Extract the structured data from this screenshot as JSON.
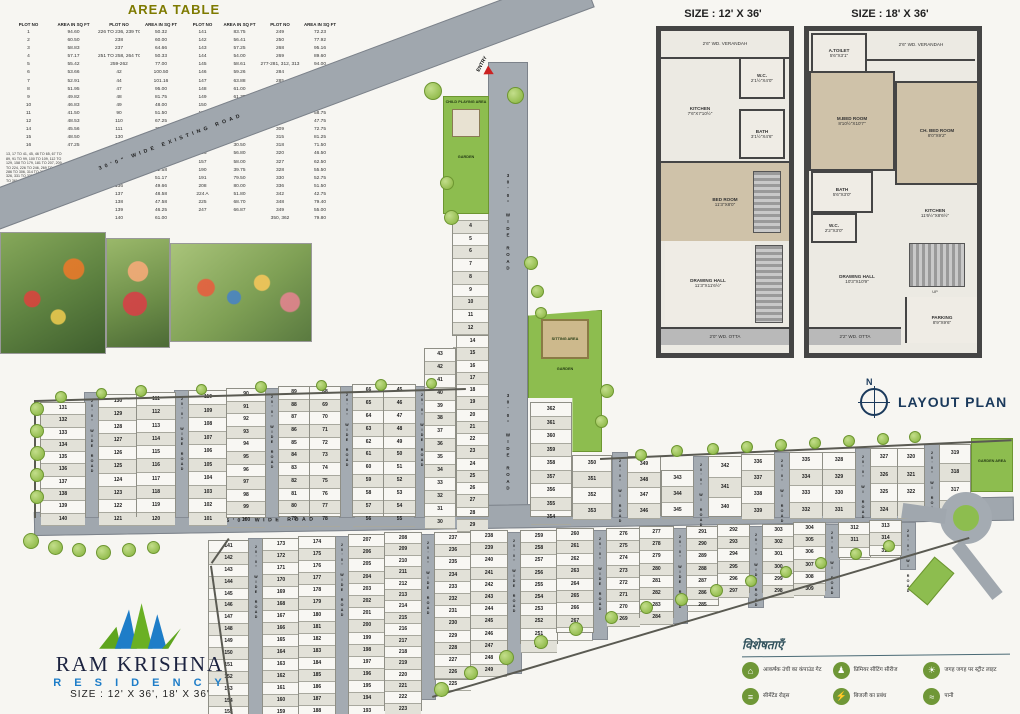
{
  "area_table": {
    "title": "AREA TABLE",
    "headers": [
      "PLOT NO",
      "AREA IN SQ FT"
    ],
    "pairs": [
      {
        "rows": [
          [
            "1",
            "94.60"
          ],
          [
            "2",
            "60.50"
          ],
          [
            "3",
            "58.83"
          ],
          [
            "4",
            "57.17"
          ],
          [
            "5",
            "55.42"
          ],
          [
            "6",
            "53.66"
          ],
          [
            "7",
            "52.91"
          ],
          [
            "8",
            "51.95"
          ],
          [
            "9",
            "49.82"
          ],
          [
            "10",
            "46.83"
          ],
          [
            "11",
            "41.50"
          ],
          [
            "12",
            "48.53"
          ],
          [
            "14",
            "45.56"
          ],
          [
            "15",
            "48.50"
          ],
          [
            "16",
            "47.25"
          ]
        ],
        "groups": [
          {
            "plots": "13, 17 TO 41, 45, 46 TO 65, 67 TO 89, 91 TO 99, 100 TO 109, 112 TO 129, 158 TO 179, 181 TO 207, 209 TO 224, 226 TO 246, 269 TO 275, 286 TO 306, 314 TO 317, 321 TO 326, 331 TO 335, 343 TO 347, 351 TO 361",
            "area": "58.30"
          },
          {
            "plots": "225, 229 TO 234, 253 TO 262, 276, 282, 283, 290 TO 298, 310, 311, 319, 337 TO 342, 345, 349, 350 TO 356",
            "area": "72.59"
          }
        ]
      },
      {
        "rows": [
          [
            "226 TO 236, 239 TO 248",
            "50.32"
          ],
          [
            "238",
            "60.00"
          ],
          [
            "237",
            "64.66"
          ],
          [
            "251 TO 258, 264 TO 267",
            "50.33"
          ],
          [
            "259-262",
            "77.00"
          ],
          [
            "42",
            "100.50"
          ],
          [
            "44",
            "101.16"
          ],
          [
            "47",
            "95.00"
          ],
          [
            "48",
            "81.75"
          ],
          [
            "49",
            "48.00"
          ],
          [
            "90",
            "51.50"
          ],
          [
            "110",
            "67.25"
          ],
          [
            "111",
            "72.60"
          ],
          [
            "130",
            "67.50"
          ],
          [
            "131",
            "108.50"
          ],
          [
            "132",
            "54.50"
          ],
          [
            "133",
            "53.83"
          ],
          [
            "134",
            "52.58"
          ],
          [
            "135",
            "51.17"
          ],
          [
            "136",
            "49.66"
          ],
          [
            "137",
            "48.58"
          ],
          [
            "138",
            "47.58"
          ],
          [
            "139",
            "46.25"
          ],
          [
            "140",
            "61.00"
          ]
        ],
        "groups": []
      },
      {
        "rows": [
          [
            "141",
            "83.75"
          ],
          [
            "142",
            "56.41"
          ],
          [
            "143",
            "57.25"
          ],
          [
            "144",
            "54.00"
          ],
          [
            "145",
            "58.61"
          ],
          [
            "146",
            "59.26"
          ],
          [
            "147",
            "63.88"
          ],
          [
            "148",
            "61.00"
          ],
          [
            "149",
            "61.75"
          ],
          [
            "150",
            "44.31"
          ],
          [
            "151",
            "35.91"
          ],
          [
            "152",
            "34.50"
          ],
          [
            "153",
            "33.36"
          ],
          [
            "154",
            "31.88"
          ],
          [
            "155",
            "30.50"
          ],
          [
            "156",
            "56.80"
          ],
          [
            "157",
            "58.00"
          ],
          [
            "190",
            "39.75"
          ],
          [
            "191",
            "79.50"
          ],
          [
            "208",
            "80.00"
          ],
          [
            "224 A",
            "51.80"
          ],
          [
            "225",
            "68.70"
          ],
          [
            "247",
            "66.87"
          ]
        ],
        "groups": []
      },
      {
        "rows": [
          [
            "249",
            "72.23"
          ],
          [
            "250",
            "77.92"
          ],
          [
            "268",
            "95.16"
          ],
          [
            "269",
            "89.60"
          ],
          [
            "277-281, 312, 313",
            "94.00"
          ],
          [
            "284",
            "41.25"
          ],
          [
            "285",
            "44.25"
          ],
          [
            "287",
            "75.75"
          ],
          [
            "288",
            "55.25"
          ],
          [
            "289",
            "54.00"
          ],
          [
            "307",
            "58.75"
          ],
          [
            "308",
            "47.75"
          ],
          [
            "309",
            "72.75"
          ],
          [
            "315",
            "81.25"
          ],
          [
            "318",
            "71.50"
          ],
          [
            "320",
            "46.50"
          ],
          [
            "327",
            "62.50"
          ],
          [
            "328",
            "55.50"
          ],
          [
            "330",
            "52.75"
          ],
          [
            "336",
            "51.50"
          ],
          [
            "342",
            "42.75"
          ],
          [
            "348",
            "79.40"
          ],
          [
            "349",
            "55.00"
          ],
          [
            "350, 362",
            "79.80"
          ]
        ],
        "groups": []
      }
    ]
  },
  "floor12": {
    "title": "SIZE : 12' X 36'",
    "verandah": "2'6\" WD. VERANDAH",
    "wc_name": "W.C.",
    "wc_dims": "2'1½\"X4'0\"",
    "kitchen_name": "KITCHEN",
    "kitchen_dims": "7'6\"X7'10½\"",
    "bath_name": "BATH",
    "bath_dims": "3'1½\"X4'6\"",
    "bed_name": "BED ROOM",
    "bed_dims": "11'3\"X8'0\"",
    "hall_name": "DRAWING HALL",
    "hall_dims": "11'3\"X11'6½\"",
    "otta": "2'0\" WD. OTTA"
  },
  "floor18": {
    "title": "SIZE : 18' X 36'",
    "toilet_name": "A.TOILET",
    "toilet_dims": "5'6\"X3'1\"",
    "verandah": "2'6\" WD. VERANDAH",
    "mbed_name": "M.BED ROOM",
    "mbed_dims": "8'10½\"X10'7\"",
    "chbed_name": "CH. BED ROOM",
    "chbed_dims": "8'0\"X9'2\"",
    "bath_name": "BATH",
    "bath_dims": "5'6\"X3'0\"",
    "kitchen_name": "KITCHEN",
    "kitchen_dims": "11'6½\"X8'6½\"",
    "wc_name": "W.C.",
    "wc_dims": "2'2\"X3'0\"",
    "hall_name": "DRAWING HALL",
    "hall_dims": "10'3\"X10'9\"",
    "up": "UP",
    "otta": "2'2\" WD. OTTA",
    "parking_name": "PARKING",
    "parking_dims": "8'9\"X9'6\""
  },
  "layout": {
    "title": "LAYOUT PLAN",
    "north": "N",
    "road_labels": {
      "existing": "30'0\" WIDE EXISTING ROAD",
      "entry": "ENTRY",
      "v30": "30'0\" WIDE ROAD",
      "h25": "25'0\" WIDE ROAD",
      "h30": "30'0\" WIDE ROAD",
      "v20": "20'0\" WIDE ROAD",
      "v20s": "20'0\" WI ROAD"
    },
    "green_labels": {
      "child_playing": "CHILD PLAYING AREA",
      "garden": "GARDEN",
      "sitting": "SITTING AREA",
      "garden_area": "GARDEN AREA"
    },
    "plot_columns": [
      {
        "id": "c1",
        "nums": [
          1,
          2,
          3,
          4,
          5,
          6,
          7,
          8,
          9,
          10,
          11,
          12,
          13
        ]
      },
      {
        "id": "c14",
        "nums": [
          14,
          15,
          16,
          17,
          18,
          19,
          20,
          21,
          22,
          23,
          24,
          25,
          26,
          27,
          28,
          29
        ]
      },
      {
        "id": "c30",
        "nums": [
          43,
          42,
          41,
          40,
          39,
          38,
          37,
          36,
          35,
          34,
          33,
          32,
          31,
          30
        ]
      },
      {
        "id": "u1",
        "nums": [
          131,
          132,
          133,
          134,
          135,
          136,
          137,
          138,
          139,
          140
        ]
      },
      {
        "id": "u2",
        "nums": [
          130,
          129,
          128,
          127,
          126,
          125,
          124,
          123,
          122,
          121
        ]
      },
      {
        "id": "u3",
        "nums": [
          111,
          112,
          113,
          114,
          115,
          116,
          117,
          118,
          119,
          120
        ]
      },
      {
        "id": "u4",
        "nums": [
          110,
          109,
          108,
          107,
          106,
          105,
          104,
          103,
          102,
          101
        ]
      },
      {
        "id": "u5",
        "nums": [
          90,
          91,
          92,
          93,
          94,
          95,
          96,
          97,
          98,
          99,
          100
        ]
      },
      {
        "id": "u6",
        "nums": [
          89,
          88,
          87,
          86,
          85,
          84,
          83,
          82,
          81,
          80,
          79
        ]
      },
      {
        "id": "u7",
        "nums": [
          68,
          69,
          70,
          71,
          72,
          73,
          74,
          75,
          76,
          77,
          78
        ]
      },
      {
        "id": "u8",
        "nums": [
          66,
          65,
          64,
          63,
          62,
          61,
          60,
          59,
          58,
          57,
          56
        ]
      },
      {
        "id": "u9",
        "nums": [
          45,
          46,
          47,
          48,
          49,
          50,
          51,
          52,
          53,
          54,
          55
        ]
      },
      {
        "id": "r1",
        "nums": [
          362,
          361,
          360,
          359,
          358,
          357,
          356,
          355,
          354
        ]
      },
      {
        "id": "r1b",
        "nums": [
          350,
          351,
          352,
          353
        ]
      },
      {
        "id": "r2a",
        "nums": [
          349,
          348,
          347,
          346
        ]
      },
      {
        "id": "r2b",
        "nums": [
          343,
          344,
          345
        ]
      },
      {
        "id": "r3a",
        "nums": [
          342,
          341,
          340
        ]
      },
      {
        "id": "r3b",
        "nums": [
          336,
          337,
          338,
          339
        ]
      },
      {
        "id": "r4a",
        "nums": [
          335,
          334,
          333,
          332
        ]
      },
      {
        "id": "r4b",
        "nums": [
          328,
          329,
          330,
          331
        ]
      },
      {
        "id": "r5a",
        "nums": [
          327,
          326,
          325,
          324
        ]
      },
      {
        "id": "r5b",
        "nums": [
          320,
          321,
          322,
          323
        ]
      },
      {
        "id": "r6",
        "nums": [
          319,
          318,
          317,
          316
        ]
      },
      {
        "id": "b1",
        "nums": [
          141,
          142,
          143,
          144,
          145,
          146,
          147,
          148,
          149,
          150,
          151,
          152,
          153,
          154,
          155,
          156
        ]
      },
      {
        "id": "b2",
        "nums": [
          173,
          172,
          171,
          170,
          169,
          168,
          167,
          166,
          165,
          164,
          163,
          162,
          161,
          160,
          159,
          158
        ]
      },
      {
        "id": "b3",
        "nums": [
          174,
          175,
          176,
          177,
          178,
          179,
          180,
          181,
          182,
          183,
          184,
          185,
          186,
          187,
          188,
          189
        ]
      },
      {
        "id": "b4",
        "nums": [
          207,
          206,
          205,
          204,
          203,
          202,
          201,
          200,
          199,
          198,
          197,
          196,
          195,
          194,
          193,
          192
        ]
      },
      {
        "id": "b5",
        "nums": [
          208,
          209,
          210,
          211,
          212,
          213,
          214,
          215,
          216,
          217,
          218,
          219,
          220,
          221,
          222,
          223,
          224
        ]
      },
      {
        "id": "b6",
        "nums": [
          237,
          236,
          235,
          234,
          233,
          232,
          231,
          230,
          229,
          228,
          227,
          226,
          225
        ]
      },
      {
        "id": "b7",
        "nums": [
          238,
          239,
          240,
          241,
          242,
          243,
          244,
          245,
          246,
          247,
          248,
          249
        ]
      },
      {
        "id": "b8",
        "nums": [
          259,
          258,
          257,
          256,
          255,
          254,
          253,
          252,
          251,
          250
        ]
      },
      {
        "id": "b9",
        "nums": [
          260,
          261,
          262,
          263,
          264,
          265,
          266,
          267,
          268
        ]
      },
      {
        "id": "b10",
        "nums": [
          276,
          275,
          274,
          273,
          272,
          271,
          270,
          269
        ]
      },
      {
        "id": "b11",
        "nums": [
          277,
          278,
          279,
          280,
          281,
          282,
          283,
          284
        ]
      },
      {
        "id": "b12",
        "nums": [
          291,
          290,
          289,
          288,
          287,
          286,
          285
        ]
      },
      {
        "id": "b13",
        "nums": [
          292,
          293,
          294,
          295,
          296,
          297
        ]
      },
      {
        "id": "b14",
        "nums": [
          303,
          302,
          301,
          300,
          299,
          298
        ]
      },
      {
        "id": "b15",
        "nums": [
          304,
          305,
          306,
          307,
          308,
          309
        ]
      },
      {
        "id": "b16",
        "nums": [
          312,
          311,
          310
        ]
      },
      {
        "id": "b17",
        "nums": [
          313,
          314,
          315
        ]
      }
    ]
  },
  "brand": {
    "name": "RAM KRISHNA",
    "sub": "R E S I D E N C Y",
    "sizes": "SIZE : 12' X 36', 18' X 36'"
  },
  "legend": {
    "title": "विशेषताएँ",
    "items": [
      {
        "icon": "gate-icon",
        "glyph": "⌂",
        "label": "आकर्षक उंची का कंपाउंड गेट"
      },
      {
        "icon": "bench-icon",
        "glyph": "♟",
        "label": "प्रिमियर सीटिंग सीरीज"
      },
      {
        "icon": "streetlight-icon",
        "glyph": "☀",
        "label": "जगह जगह पर स्ट्रीट लाइट"
      },
      {
        "icon": "road-icon",
        "glyph": "≡",
        "label": "सीमेंटेड रोड्स"
      },
      {
        "icon": "electricity-icon",
        "glyph": "⚡",
        "label": "बिजली का प्रबंध"
      },
      {
        "icon": "water-icon",
        "glyph": "≈",
        "label": "पानी"
      }
    ]
  }
}
